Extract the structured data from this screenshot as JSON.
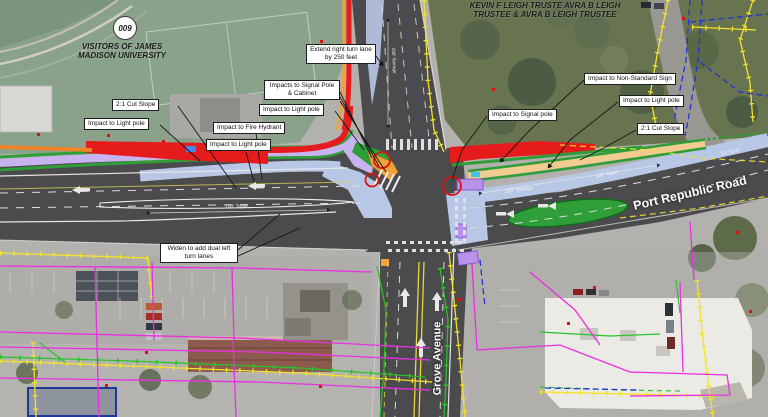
{
  "parcels": {
    "north_owner_line1": "KEVIN F LEIGH TRUSTE AVRA B LEIGH",
    "north_owner_line2": "TRUSTEE & AVRA B LEIGH TRUSTEE",
    "west_owner_line1": "VISITORS OF JAMES",
    "west_owner_line2": "MADISON UNIVERSITY",
    "parcel_badge": "009"
  },
  "roads": {
    "east_west_name": "Port Republic Road",
    "south_name": "Grove Avenue"
  },
  "callouts": [
    {
      "id": "cut-slope-west",
      "label": "2:1 Cut Slope"
    },
    {
      "id": "light-pole-west",
      "label": "Impact to Light pole"
    },
    {
      "id": "fire-hydrant",
      "label": "Impact to Fire Hydrant"
    },
    {
      "id": "light-pole-mid",
      "label": "Impact to Light pole"
    },
    {
      "id": "signal-pole-cabinet",
      "label": "Impacts to Signal Pole & Cabinet"
    },
    {
      "id": "light-pole-center",
      "label": "Impact to Light pole"
    },
    {
      "id": "extend-right-turn",
      "label": "Extend right turn lane by 250 feet"
    },
    {
      "id": "non-standard-sign",
      "label": "Impact to Non-Standard Sign"
    },
    {
      "id": "light-pole-east",
      "label": "Impact to Light pole"
    },
    {
      "id": "signal-pole-east",
      "label": "Impact to Signal pole"
    },
    {
      "id": "cut-slope-east",
      "label": "2:1 Cut Slope"
    },
    {
      "id": "widen-dual-left",
      "label": "Widen to add dual left turn lanes"
    }
  ],
  "pavement_labels": [
    {
      "text": "150' Taper"
    },
    {
      "text": "100' Storage"
    },
    {
      "text": "100' Taper"
    },
    {
      "text": "50' Taper"
    },
    {
      "text": "250' Storage"
    }
  ],
  "colors": {
    "impact_red": "#e61c1c",
    "buffer_green": "#2f9e38",
    "shared_use_purple": "#c7b4ee",
    "widening_blue": "#b9c7e6",
    "path_tan": "#f2cb90",
    "utility_yellow": "#f2e32c",
    "utility_green": "#27c427",
    "property_magenta": "#ea2fe2",
    "parcel_blue": "#2433d6",
    "road_gray": "#4b4b4d"
  }
}
